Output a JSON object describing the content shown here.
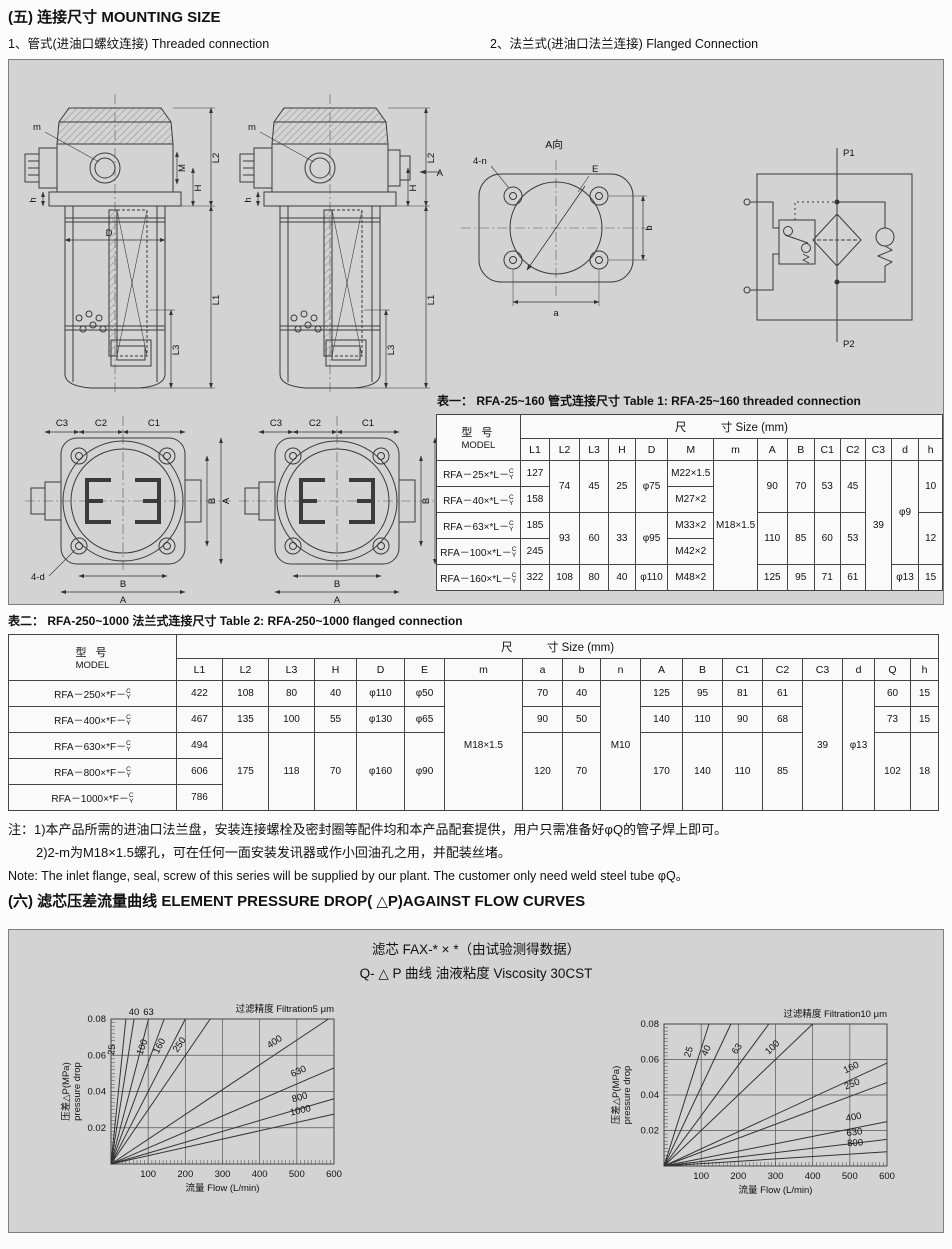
{
  "page": {
    "section5_title": "(五) 连接尺寸  MOUNTING SIZE",
    "sub1": "1、管式(进油口螺纹连接)  Threaded connection",
    "sub2": "2、法兰式(进油口法兰连接)  Flanged Connection",
    "section6_title": "(六) 滤芯压差流量曲线   ELEMENT PRESSURE DROP( △P)AGAINST FLOW CURVES"
  },
  "drawings": {
    "threaded_view": {
      "labels": {
        "m": "m",
        "M": "M",
        "H": "H",
        "h": "h",
        "D": "D",
        "L1": "L1",
        "L2": "L2",
        "L3": "L3"
      }
    },
    "flanged_view": {
      "labels": {
        "m": "m",
        "A": "A",
        "H": "H",
        "h": "h",
        "L1": "L1",
        "L2": "L2",
        "L3": "L3"
      }
    },
    "bottom_view": {
      "labels": {
        "C1": "C1",
        "C2": "C2",
        "C3": "C3",
        "A": "A",
        "B": "B",
        "d": "4-d"
      }
    },
    "flange_face": {
      "title": "A向",
      "labels": {
        "n": "4-n",
        "E": "E",
        "a": "a",
        "b": "b"
      }
    },
    "circuit": {
      "p1": "P1",
      "p2": "P2"
    }
  },
  "table1": {
    "title": "表一：  RFA-25~160 管式连接尺寸   Table 1: RFA-25~160 threaded connection",
    "header_model_cn": "型  号",
    "header_model_en": "MODEL",
    "size_header": "尺　　　寸  Size  (mm)",
    "suffix_top": "C",
    "suffix_bottom": "Y",
    "columns": [
      "L1",
      "L2",
      "L3",
      "H",
      "D",
      "M",
      "m",
      "A",
      "B",
      "C1",
      "C2",
      "C3",
      "d",
      "h"
    ],
    "rows": [
      [
        {
          "m": "RFA－25×*L－"
        },
        {
          "t": "127"
        },
        {
          "t": "74",
          "rs": 2
        },
        {
          "t": "45",
          "rs": 2
        },
        {
          "t": "25",
          "rs": 2
        },
        {
          "t": "φ75",
          "rs": 2
        },
        {
          "t": "M22×1.5"
        },
        {
          "t": "M18×1.5",
          "rs": 5
        },
        {
          "t": "90",
          "rs": 2
        },
        {
          "t": "70",
          "rs": 2
        },
        {
          "t": "53",
          "rs": 2
        },
        {
          "t": "45",
          "rs": 2
        },
        {
          "t": "39",
          "rs": 5
        },
        {
          "t": "φ9",
          "rs": 4
        },
        {
          "t": "10",
          "rs": 2
        }
      ],
      [
        {
          "m": "RFA－40×*L－"
        },
        {
          "t": "158"
        },
        {
          "t": "M27×2"
        }
      ],
      [
        {
          "m": "RFA－63×*L－"
        },
        {
          "t": "185"
        },
        {
          "t": "93",
          "rs": 2
        },
        {
          "t": "60",
          "rs": 2
        },
        {
          "t": "33",
          "rs": 2
        },
        {
          "t": "φ95",
          "rs": 2
        },
        {
          "t": "M33×2"
        },
        {
          "t": "110",
          "rs": 2
        },
        {
          "t": "85",
          "rs": 2
        },
        {
          "t": "60",
          "rs": 2
        },
        {
          "t": "53",
          "rs": 2
        },
        {
          "t": "12",
          "rs": 2
        }
      ],
      [
        {
          "m": "RFA－100×*L－"
        },
        {
          "t": "245"
        },
        {
          "t": "M42×2"
        }
      ],
      [
        {
          "m": "RFA－160×*L－"
        },
        {
          "t": "322"
        },
        {
          "t": "108"
        },
        {
          "t": "80"
        },
        {
          "t": "40"
        },
        {
          "t": "φ110"
        },
        {
          "t": "M48×2"
        },
        {
          "t": "125"
        },
        {
          "t": "95"
        },
        {
          "t": "71"
        },
        {
          "t": "61"
        },
        {
          "t": "φ13"
        },
        {
          "t": "15"
        }
      ]
    ]
  },
  "table2": {
    "title": "表二：  RFA-250~1000 法兰式连接尺寸   Table 2: RFA-250~1000 flanged  connection",
    "header_model_cn": "型  号",
    "header_model_en": "MODEL",
    "size_header": "尺　　　寸  Size  (mm)",
    "suffix_top": "C",
    "suffix_bottom": "Y",
    "columns": [
      "L1",
      "L2",
      "L3",
      "H",
      "D",
      "E",
      "m",
      "a",
      "b",
      "n",
      "A",
      "B",
      "C1",
      "C2",
      "C3",
      "d",
      "Q",
      "h"
    ],
    "rows": [
      [
        {
          "m": "RFA－250×*F－"
        },
        {
          "t": "422"
        },
        {
          "t": "108"
        },
        {
          "t": "80"
        },
        {
          "t": "40"
        },
        {
          "t": "φ110"
        },
        {
          "t": "φ50"
        },
        {
          "t": "M18×1.5",
          "rs": 5
        },
        {
          "t": "70"
        },
        {
          "t": "40"
        },
        {
          "t": "M10",
          "rs": 5
        },
        {
          "t": "125"
        },
        {
          "t": "95"
        },
        {
          "t": "81"
        },
        {
          "t": "61"
        },
        {
          "t": "39",
          "rs": 5
        },
        {
          "t": "φ13",
          "rs": 5
        },
        {
          "t": "60"
        },
        {
          "t": "15"
        }
      ],
      [
        {
          "m": "RFA－400×*F－"
        },
        {
          "t": "467"
        },
        {
          "t": "135"
        },
        {
          "t": "100"
        },
        {
          "t": "55"
        },
        {
          "t": "φ130"
        },
        {
          "t": "φ65"
        },
        {
          "t": "90"
        },
        {
          "t": "50"
        },
        {
          "t": "140"
        },
        {
          "t": "110"
        },
        {
          "t": "90"
        },
        {
          "t": "68"
        },
        {
          "t": "73"
        },
        {
          "t": "15"
        }
      ],
      [
        {
          "m": "RFA－630×*F－"
        },
        {
          "t": "494"
        },
        {
          "t": "175",
          "rs": 3
        },
        {
          "t": "118",
          "rs": 3
        },
        {
          "t": "70",
          "rs": 3
        },
        {
          "t": "φ160",
          "rs": 3
        },
        {
          "t": "φ90",
          "rs": 3
        },
        {
          "t": "120",
          "rs": 3
        },
        {
          "t": "70",
          "rs": 3
        },
        {
          "t": "170",
          "rs": 3
        },
        {
          "t": "140",
          "rs": 3
        },
        {
          "t": "110",
          "rs": 3
        },
        {
          "t": "85",
          "rs": 3
        },
        {
          "t": "102",
          "rs": 3
        },
        {
          "t": "18",
          "rs": 3
        }
      ],
      [
        {
          "m": "RFA－800×*F－"
        },
        {
          "t": "606"
        }
      ],
      [
        {
          "m": "RFA－1000×*F－"
        },
        {
          "t": "786"
        }
      ]
    ]
  },
  "notes": {
    "line1": "注：1)本产品所需的进油口法兰盘，安装连接螺栓及密封圈等配件均和本产品配套提供，用户只需准备好φQ的管子焊上即可。",
    "line2": "2)2-m为M18×1.5螺孔，可在任何一面安装发讯器或作小回油孔之用，并配装丝堵。",
    "line3": "Note: The inlet flange, seal, screw of this series will be supplied by our plant. The customer only need weld steel tube φQ。"
  },
  "charts_panel": {
    "title1": "滤芯 FAX-* × *（由试验测得数据）",
    "title2": "Q- △ P 曲线 油液粘度 Viscosity 30CST"
  },
  "chart_data": [
    {
      "type": "line",
      "title": "过滤精度 Filtration5 μm",
      "xlabel": "流量 Flow   (L/min)",
      "ylabel": "压差△P(MPa)",
      "ylabel2": "pressure drop",
      "xlim": [
        0,
        600
      ],
      "ylim": [
        0,
        0.08
      ],
      "xticks": [
        100,
        200,
        300,
        400,
        500,
        600
      ],
      "yticks": [
        0.02,
        0.04,
        0.06,
        0.08
      ],
      "grid": true,
      "legend_position": "on-line-labels",
      "series": [
        {
          "name": "25",
          "points": [
            [
              0,
              0
            ],
            [
              40,
              0.08
            ]
          ],
          "end": [
            40,
            0.08
          ]
        },
        {
          "name": "40",
          "points": [
            [
              0,
              0
            ],
            [
              62,
              0.08
            ]
          ],
          "end": [
            62,
            0.08
          ],
          "label_top": true
        },
        {
          "name": "63",
          "points": [
            [
              0,
              0
            ],
            [
              101,
              0.08
            ]
          ],
          "end": [
            101,
            0.08
          ],
          "label_top": true
        },
        {
          "name": "100",
          "points": [
            [
              0,
              0
            ],
            [
              143,
              0.08
            ]
          ],
          "end": [
            143,
            0.08
          ]
        },
        {
          "name": "160",
          "points": [
            [
              0,
              0
            ],
            [
              200,
              0.08
            ]
          ],
          "end": [
            200,
            0.08
          ]
        },
        {
          "name": "250",
          "points": [
            [
              0,
              0
            ],
            [
              267,
              0.08
            ]
          ],
          "end": [
            267,
            0.08
          ]
        },
        {
          "name": "400",
          "points": [
            [
              0,
              0
            ],
            [
              585,
              0.08
            ]
          ],
          "end": [
            585,
            0.08
          ]
        },
        {
          "name": "630",
          "points": [
            [
              0,
              0
            ],
            [
              600,
              0.053
            ]
          ],
          "end": [
            600,
            0.053
          ]
        },
        {
          "name": "800",
          "points": [
            [
              0,
              0
            ],
            [
              600,
              0.036
            ]
          ],
          "end": [
            600,
            0.036
          ]
        },
        {
          "name": "1000",
          "points": [
            [
              0,
              0
            ],
            [
              600,
              0.0275
            ]
          ],
          "end": [
            600,
            0.0275
          ]
        }
      ]
    },
    {
      "type": "line",
      "title": "过滤精度 Filtration10 μm",
      "xlabel": "流量 Flow   (L/min)",
      "ylabel": "压差△P(MPa)",
      "ylabel2": "pressure drop",
      "xlim": [
        0,
        600
      ],
      "ylim": [
        0,
        0.08
      ],
      "xticks": [
        100,
        200,
        300,
        400,
        500,
        600
      ],
      "yticks": [
        0.02,
        0.04,
        0.06,
        0.08
      ],
      "grid": true,
      "legend_position": "on-line-labels",
      "series": [
        {
          "name": "25",
          "points": [
            [
              0,
              0
            ],
            [
              121,
              0.08
            ]
          ],
          "end": [
            121,
            0.08
          ]
        },
        {
          "name": "40",
          "points": [
            [
              0,
              0
            ],
            [
              180,
              0.08
            ]
          ],
          "end": [
            180,
            0.08
          ]
        },
        {
          "name": "63",
          "points": [
            [
              0,
              0
            ],
            [
              282,
              0.08
            ]
          ],
          "end": [
            282,
            0.08
          ]
        },
        {
          "name": "100",
          "points": [
            [
              0,
              0
            ],
            [
              400,
              0.08
            ]
          ],
          "end": [
            400,
            0.08
          ]
        },
        {
          "name": "160",
          "points": [
            [
              0,
              0
            ],
            [
              600,
              0.058
            ]
          ],
          "end": [
            600,
            0.058
          ]
        },
        {
          "name": "250",
          "points": [
            [
              0,
              0
            ],
            [
              600,
              0.047
            ]
          ],
          "end": [
            600,
            0.047
          ]
        },
        {
          "name": "400",
          "points": [
            [
              0,
              0
            ],
            [
              600,
              0.025
            ]
          ],
          "end": [
            600,
            0.025
          ]
        },
        {
          "name": "630",
          "points": [
            [
              0,
              0
            ],
            [
              600,
              0.015
            ]
          ],
          "end": [
            600,
            0.015
          ]
        },
        {
          "name": "800",
          "points": [
            [
              0,
              0
            ],
            [
              600,
              0.008
            ]
          ],
          "end": [
            600,
            0.008
          ]
        }
      ]
    }
  ]
}
